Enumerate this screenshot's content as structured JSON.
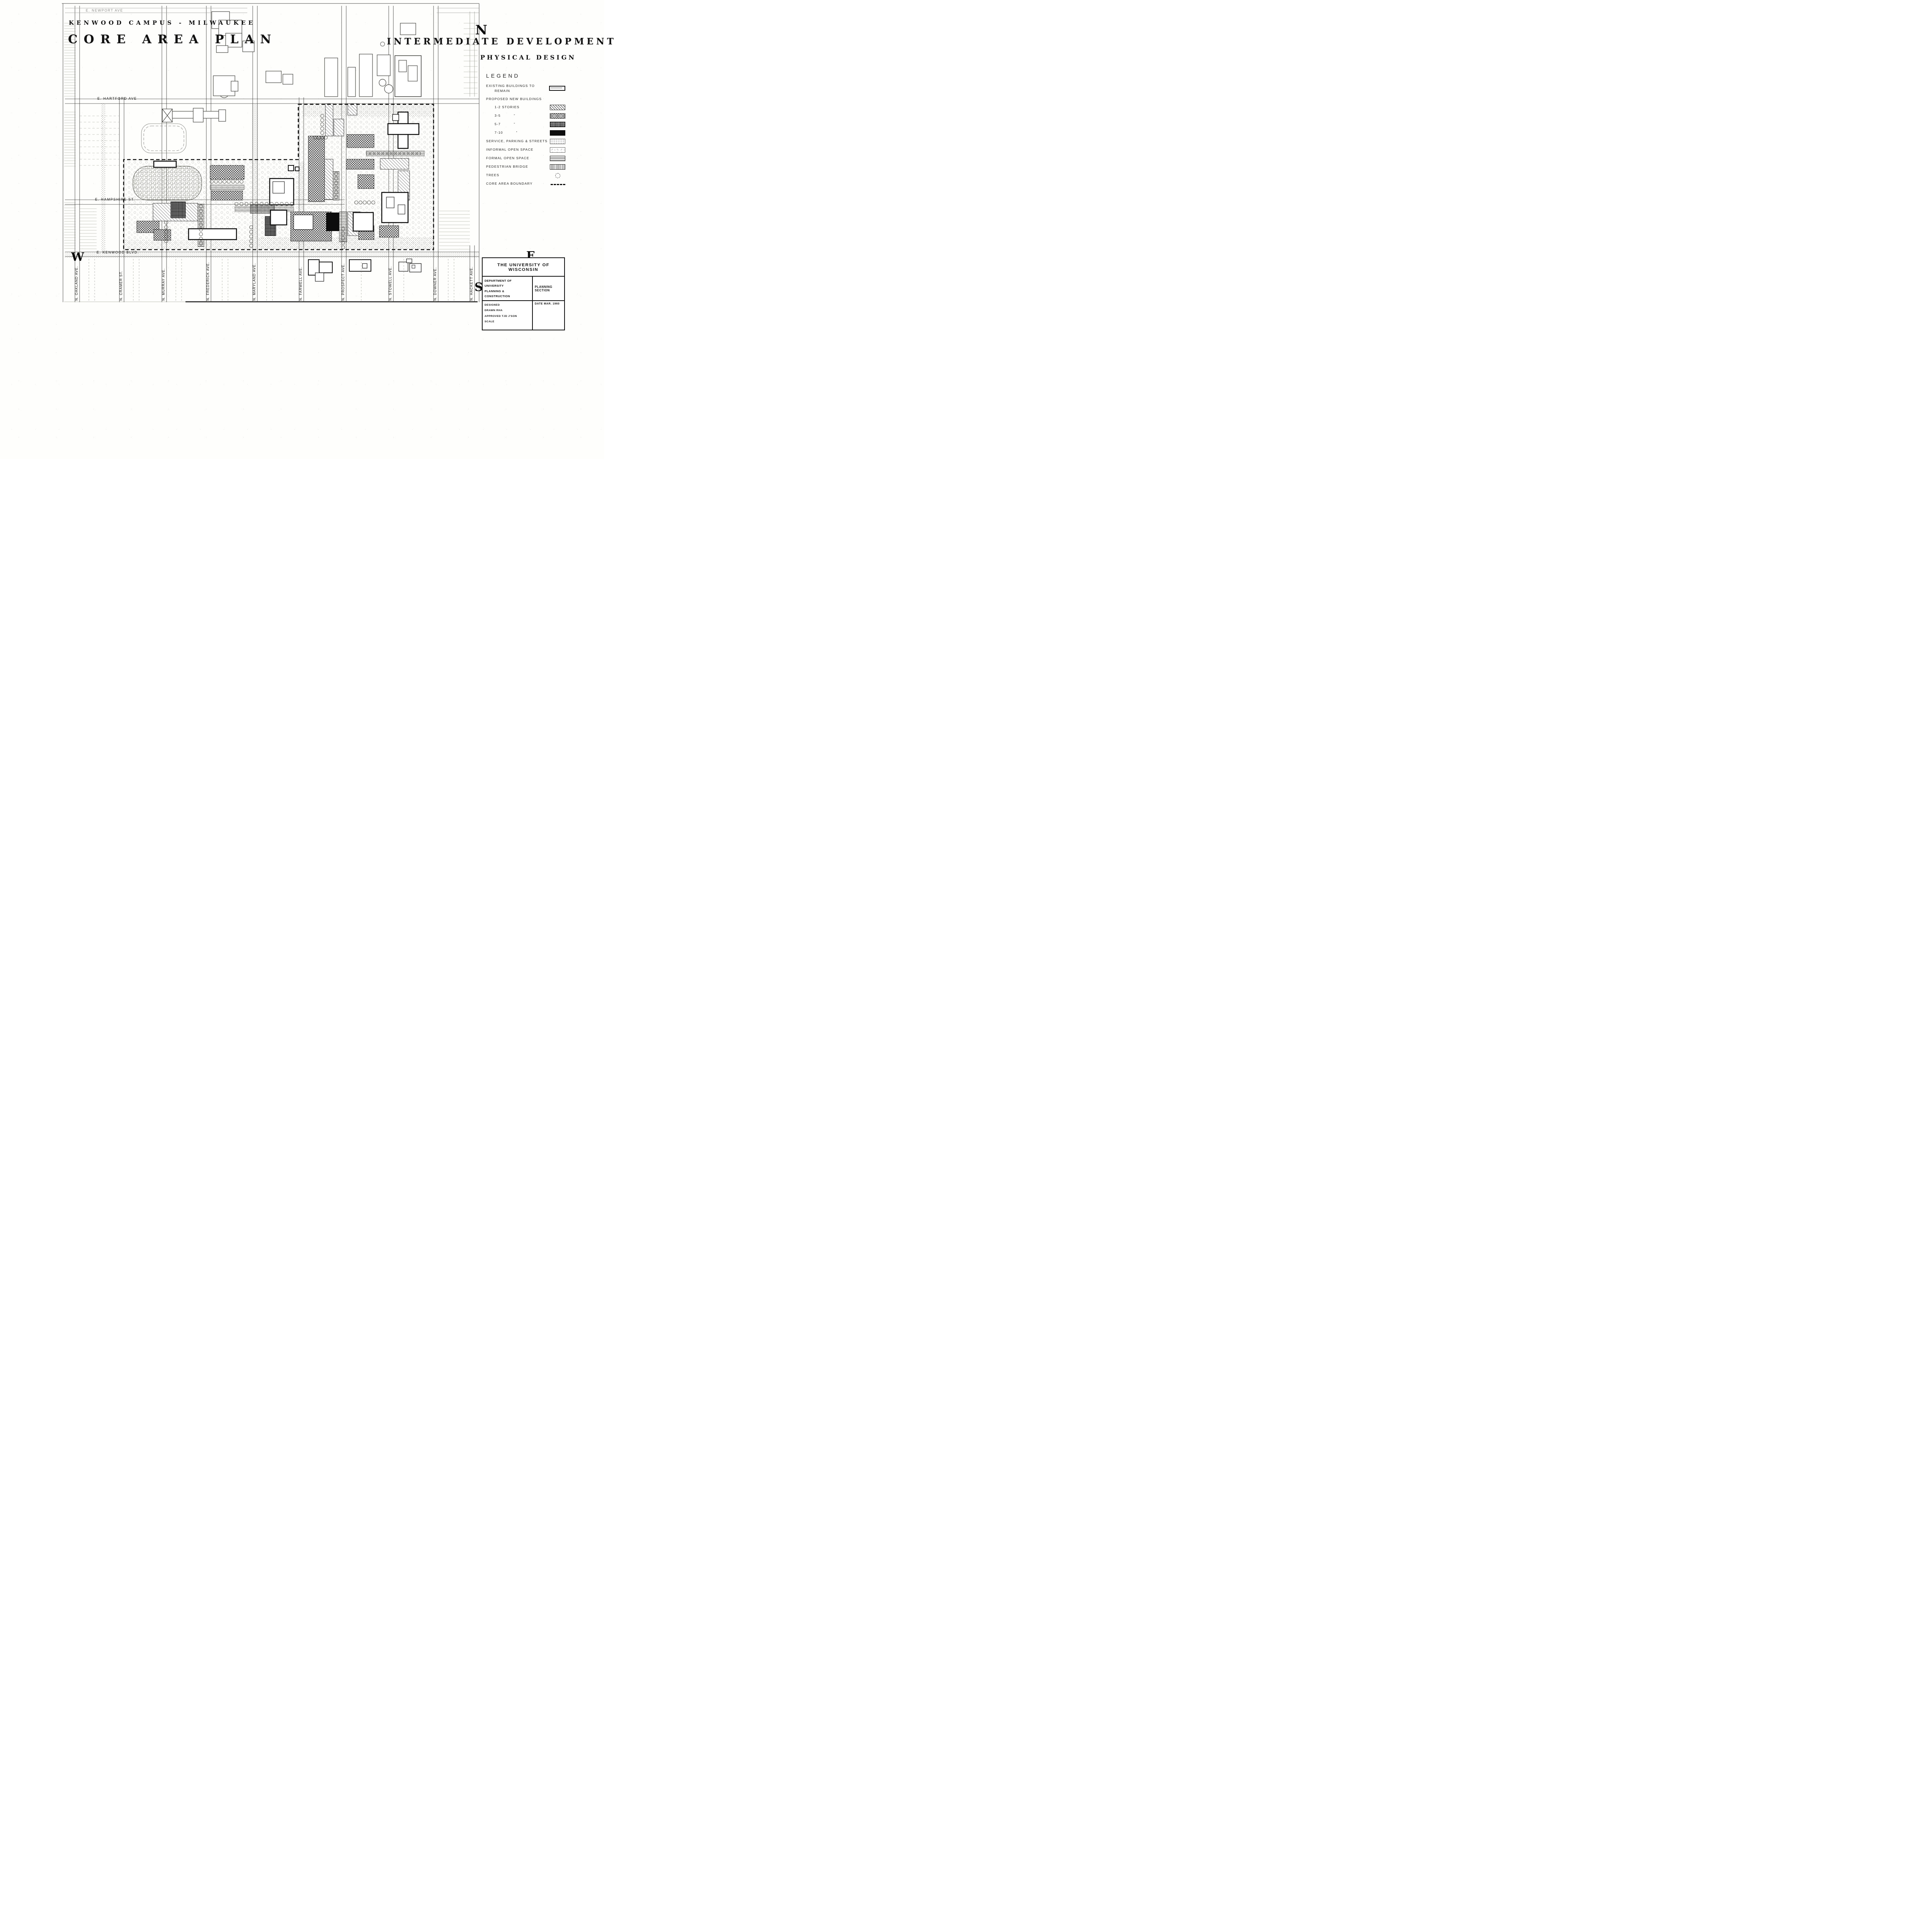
{
  "titles": {
    "campus": "KENWOOD CAMPUS - MILWAUKEE",
    "main": "CORE AREA PLAN",
    "right1": "INTERMEDIATE DEVELOPMENT",
    "right2": "PHYSICAL DESIGN"
  },
  "compass": {
    "north": "N",
    "east": "E",
    "west": "W",
    "south": "S"
  },
  "legend": {
    "heading": "LEGEND",
    "items": [
      {
        "label": "EXISTING BUILDINGS TO",
        "label2": "REMAIN",
        "swatch": "existing",
        "indent": false
      },
      {
        "label": "PROPOSED NEW BUILDINGS",
        "swatch": "none",
        "indent": false
      },
      {
        "label": "1-2  STORIES",
        "swatch": "hatch12",
        "indent": true
      },
      {
        "label": "3-5",
        "ditto": "\"",
        "swatch": "hatch35",
        "indent": true
      },
      {
        "label": "5-7",
        "ditto": "\"",
        "swatch": "hatch57",
        "indent": true
      },
      {
        "label": "7-10",
        "ditto": "\"",
        "swatch": "hatch710",
        "indent": true
      },
      {
        "label": "SERVICE, PARKING & STREETS",
        "swatch": "service",
        "indent": false
      },
      {
        "label": "INFORMAL OPEN SPACE",
        "swatch": "informal",
        "indent": false
      },
      {
        "label": "FORMAL OPEN SPACE",
        "swatch": "formal",
        "indent": false
      },
      {
        "label": "PEDESTRIAN BRIDGE",
        "swatch": "bridge",
        "indent": false
      },
      {
        "label": "TREES",
        "swatch": "trees",
        "indent": false
      },
      {
        "label": "CORE AREA BOUNDARY",
        "swatch": "boundary",
        "indent": false
      }
    ]
  },
  "streets": {
    "horizontal": [
      "E. NEWPORT  AVE",
      "E. HARTFORD  AVE",
      "E. HAMPSHIRE  ST.",
      "E. KENWOOD  BLVD."
    ],
    "vertical": [
      "N. OAKLAND  AVE.",
      "N. CRAMER  ST.",
      "N. MURRAY  AVE.",
      "N. FREDERICK  AVE.",
      "N. MARYLAND  AVE.",
      "N. FARWELL  AVE.",
      "N. PROSPECT  AVE.",
      "N. STOWELL  AVE.",
      "N. DOWNER  AVE.",
      "N. HACKETT  AVE."
    ]
  },
  "titleblock": {
    "org": "THE UNIVERSITY OF WISCONSIN",
    "dept_line1": "DEPARTMENT OF UNIVERSITY",
    "dept_line2": "PLANNING & CONSTRUCTION",
    "section": "PLANNING SECTION",
    "designed": "DESIGNED",
    "drawn": "DRAWN   RHA",
    "approved": "APPROVED   TJD   J'SON",
    "scale": "SCALE",
    "date": "DATE   MAR.  1960"
  }
}
